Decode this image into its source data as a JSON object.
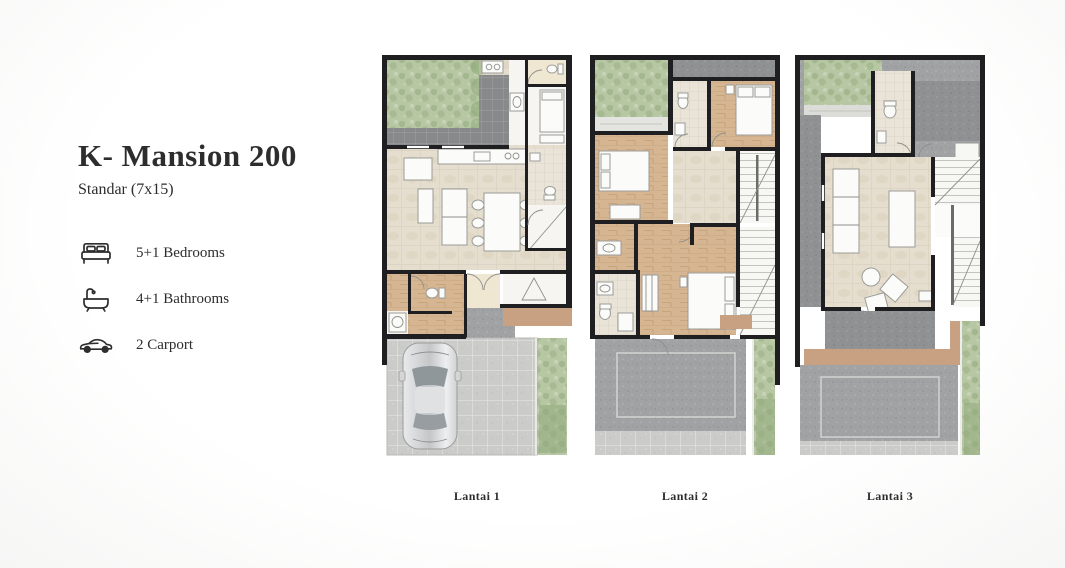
{
  "info": {
    "title": "K- Mansion 200",
    "subtitle": "Standar (7x15)",
    "features": [
      {
        "icon": "bed-icon",
        "label": "5+1 Bedrooms"
      },
      {
        "icon": "bathtub-icon",
        "label": "4+1 Bathrooms"
      },
      {
        "icon": "car-icon",
        "label": "2 Carport"
      }
    ]
  },
  "floors": [
    {
      "label": "Lantai 1"
    },
    {
      "label": "Lantai 2"
    },
    {
      "label": "Lantai 3"
    }
  ],
  "colors": {
    "c-wall": "#1f1f22",
    "c-grass": "#b7c7a3",
    "c-grass-dark": "#8fa87a",
    "c-darktile": "#87898b",
    "c-paving": "#cbcbc9",
    "c-roof": "#a0a2a4",
    "c-concrete": "#8f9193",
    "c-wood": "#d6b692",
    "c-marble": "#e5decf",
    "c-bathtile": "#eae4d8",
    "c-cream": "#efe7d2",
    "c-deck": "#c8a183",
    "c-text": "#2d2d2d"
  }
}
